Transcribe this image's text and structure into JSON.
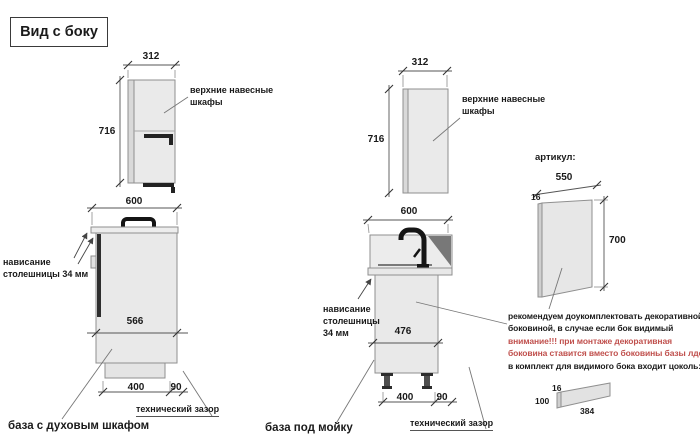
{
  "title": "Вид с боку",
  "colors": {
    "warning_red": "#c0504d",
    "cabinet_fill": "#e9e9e9",
    "line_grey": "#8f8f8f"
  },
  "wall_cabinet_left": {
    "width_mm": "312",
    "height_mm": "716",
    "label_l1": "верхние навесные",
    "label_l2": "шкафы"
  },
  "oven_base": {
    "width_mm": "600",
    "overhang_l1": "нависание",
    "overhang_l2": "столешницы 34 мм",
    "depth_mm": "566",
    "plinth_mm": "400",
    "gap_mm": "90",
    "tech_gap": "технический зазор",
    "caption": "база с духовым шкафом"
  },
  "wall_cabinet_mid": {
    "width_mm": "312",
    "height_mm": "716",
    "label_l1": "верхние навесные",
    "label_l2": "шкафы"
  },
  "sink_base": {
    "width_mm": "600",
    "overhang_l1": "нависание",
    "overhang_l2": "столешницы",
    "overhang_l3": "34 мм",
    "depth_mm": "476",
    "plinth_mm": "400",
    "gap_mm": "90",
    "tech_gap": "технический зазор",
    "caption": "база под мойку"
  },
  "side_panel": {
    "heading": "артикул:",
    "width_mm": "550",
    "thickness_mm": "16",
    "height_mm": "700"
  },
  "note": {
    "l1": "рекомендуем доукомплектовать декоративной",
    "l2": "боковиной, в случае если бок видимый",
    "l3": "внимание!!! при монтаже декоративная",
    "l4": "боковина ставится вместо боковины базы лдсп",
    "l5": "в комплект для видимого бока входит цоколь:"
  },
  "plinth": {
    "thickness_mm": "16",
    "height_mm": "100",
    "length_mm": "384"
  }
}
